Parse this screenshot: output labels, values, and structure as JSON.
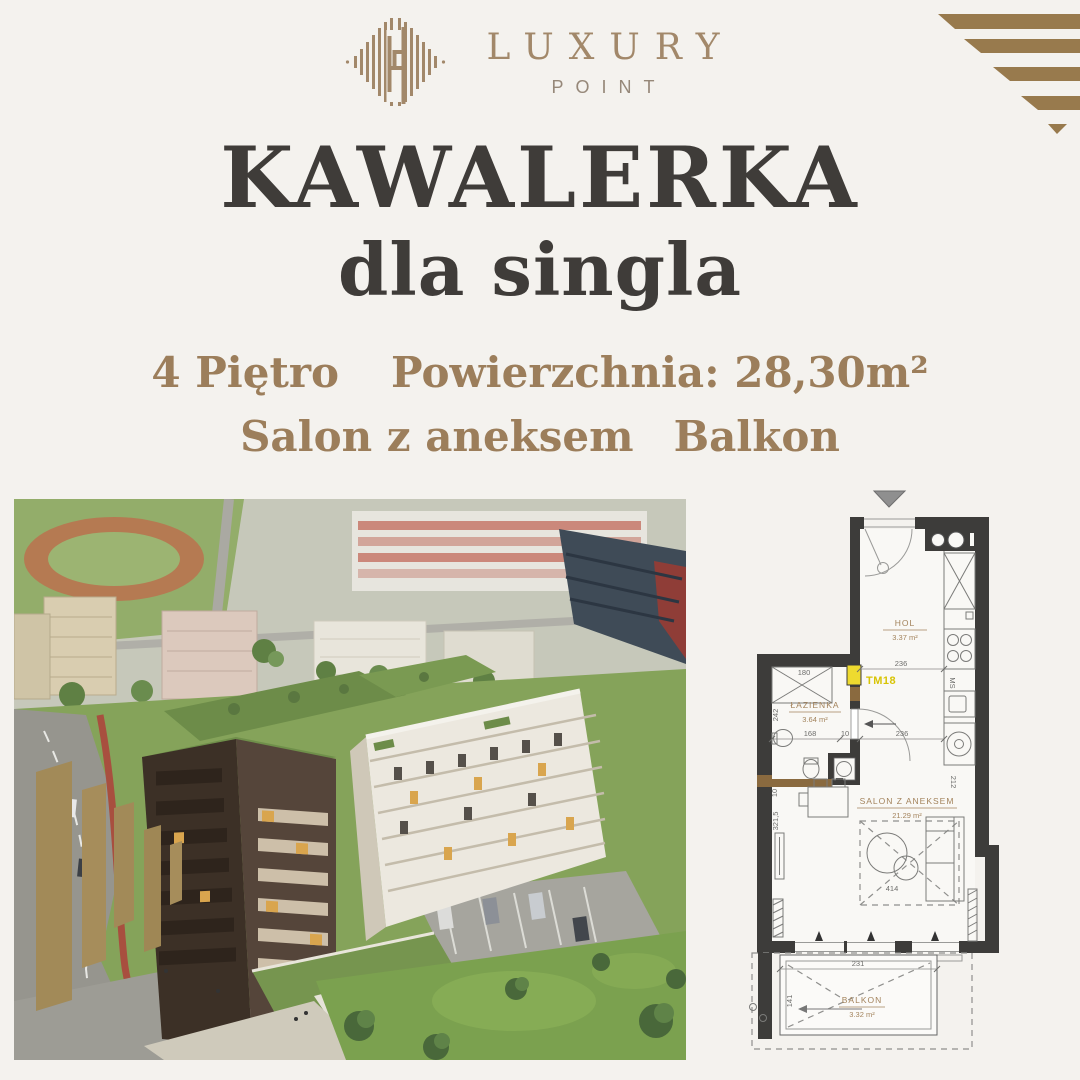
{
  "brand": {
    "name": "LUXURY",
    "tagline": "POINT"
  },
  "hero": {
    "title": "KAWALERKA",
    "subtitle": "dla singla"
  },
  "specs": {
    "floor": "4 Piętro",
    "area": "Powierzchnia: 28,30m²",
    "layout": "Salon z aneksem",
    "extra": "Balkon"
  },
  "plan": {
    "unit": "TM18",
    "rooms": {
      "hol": {
        "name": "HOL",
        "area": "3.37 m²"
      },
      "bathroom": {
        "name": "ŁAZIENKA",
        "area": "3.64 m²"
      },
      "salon": {
        "name": "SALON Z ANEKSEM",
        "area": "21.29 m²"
      },
      "balcony": {
        "name": "BALKON",
        "area": "3.32 m²"
      }
    },
    "dims": {
      "hall_width": "236",
      "kitchen_width": "236",
      "bath_width": "180",
      "bath_depth": "242",
      "bath_inner": "168",
      "door": "10",
      "salon_side_top": "10",
      "salon_depth": "321,5",
      "armchair_zone": "414",
      "kitchen_run": "212",
      "kitchen_note": "MS",
      "balcony_width": "231",
      "balcony_depth": "141"
    }
  },
  "colors": {
    "background": "#f4f2ee",
    "gold": "#9c7e5b",
    "heading": "#3f3c39",
    "wall": "#3d3c3a",
    "unit_highlight": "#eeda2f"
  }
}
